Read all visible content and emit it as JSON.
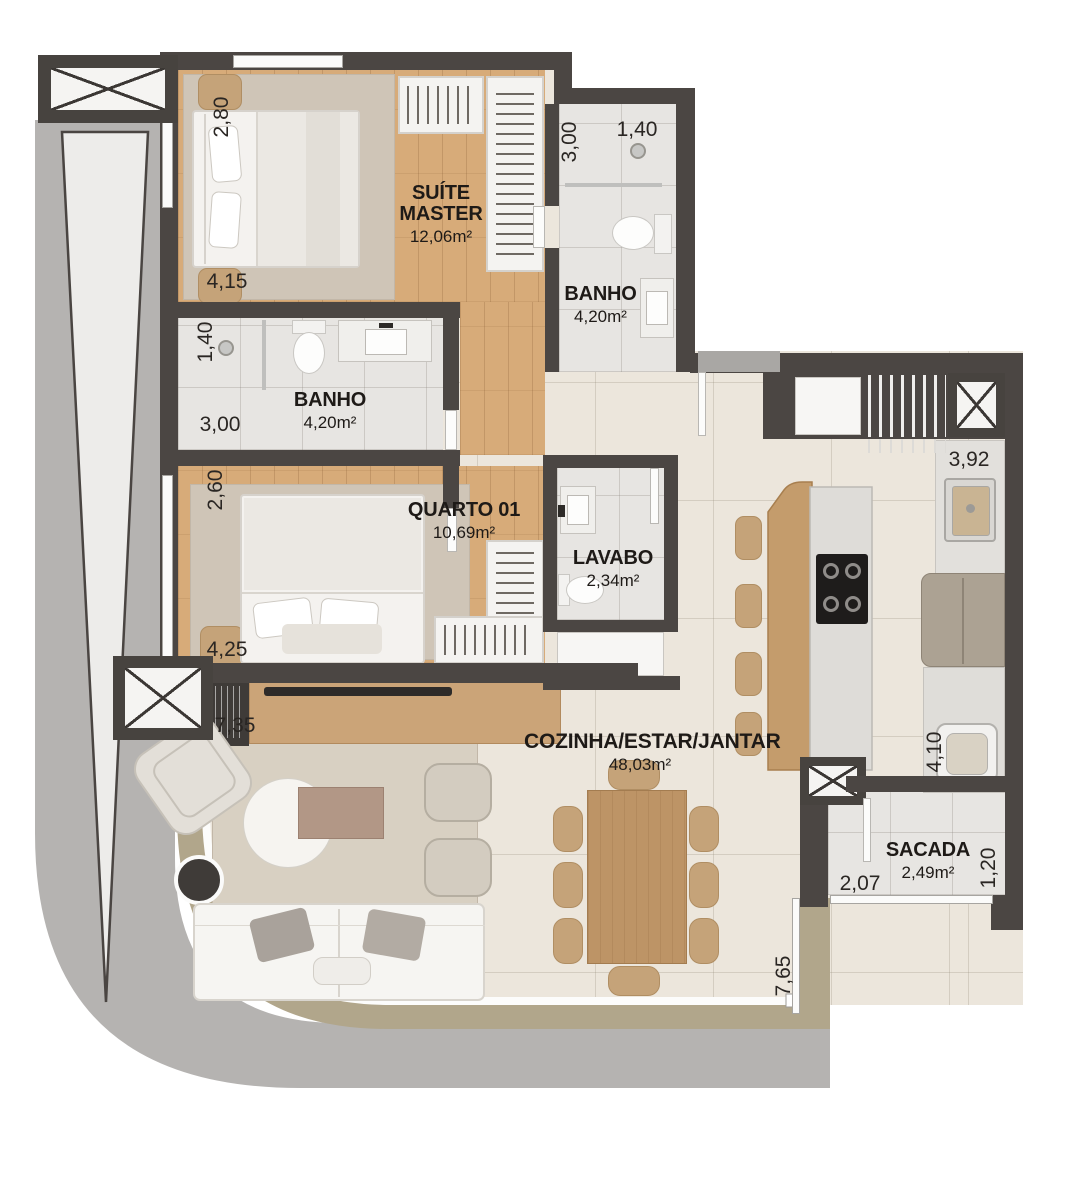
{
  "rooms": {
    "suite": {
      "name": "SUÍTE MASTER",
      "area": "12,06m²"
    },
    "banho_suite": {
      "name": "BANHO",
      "area": "4,20m²"
    },
    "banho_social": {
      "name": "BANHO",
      "area": "4,20m²"
    },
    "quarto": {
      "name": "QUARTO 01",
      "area": "10,69m²"
    },
    "lavabo": {
      "name": "LAVABO",
      "area": "2,34m²"
    },
    "cozinha": {
      "name": "COZINHA/ESTAR/JANTAR",
      "area": "48,03m²"
    },
    "sacada": {
      "name": "SACADA",
      "area": "2,49m²"
    }
  },
  "dimensions": {
    "suite_v": "2,80",
    "suite_h": "4,15",
    "banho_suite_v": "3,00",
    "banho_suite_h": "1,40",
    "banho_social_v": "1,40",
    "banho_social_h": "3,00",
    "quarto_v": "2,60",
    "quarto_h": "4,25",
    "living_w": "7,35",
    "living_v": "7,65",
    "kitchen_w": "3,92",
    "kitchen_v": "4,10",
    "sacada_w": "2,07",
    "sacada_v": "1,20"
  },
  "colors": {
    "wall": "#4b4643",
    "wood_floor": "#d7ab79",
    "rug": "#cfc5b7",
    "tile_floor": "#ece6dc",
    "bath_floor": "#e7e5e2",
    "concrete": "#b5b3b1",
    "deck": "#b1a68b",
    "furniture_tan": "#c5a379",
    "label_text": "#1e1a17"
  }
}
